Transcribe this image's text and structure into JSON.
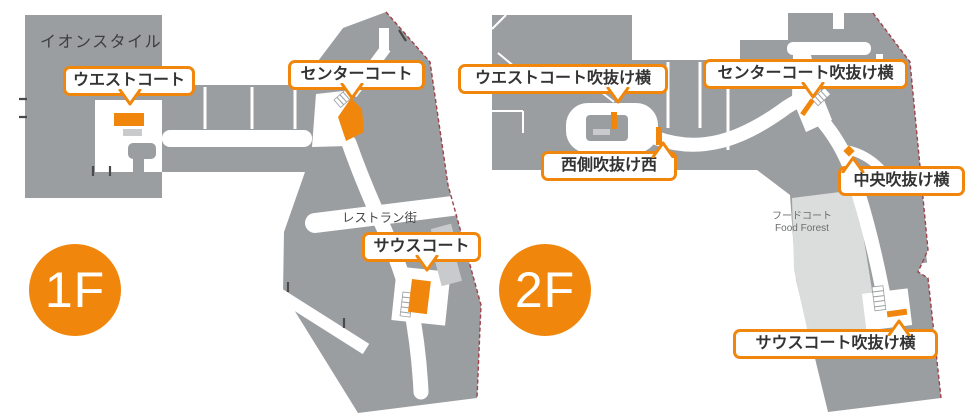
{
  "colors": {
    "orange": "#F0870C",
    "building_gray": "#9B9EA1",
    "light_gray": "#C9CACB",
    "foodcourt_gray": "#DBDCDC",
    "boundary_red": "#A04048",
    "text_dark": "#333333"
  },
  "floors": [
    {
      "badge": "1F",
      "area_labels": [
        {
          "text": "イオンスタイル"
        },
        {
          "text": "レストラン街"
        }
      ],
      "callouts": [
        {
          "label": "ウエストコート"
        },
        {
          "label": "センターコート"
        },
        {
          "label": "サウスコート"
        }
      ]
    },
    {
      "badge": "2F",
      "area_labels": [
        {
          "text": "フードコート"
        },
        {
          "text": "Food Forest"
        }
      ],
      "callouts": [
        {
          "label": "ウエストコート吹抜け横"
        },
        {
          "label": "センターコート吹抜け横"
        },
        {
          "label": "西側吹抜け西"
        },
        {
          "label": "中央吹抜け横"
        },
        {
          "label": "サウスコート吹抜け横"
        }
      ]
    }
  ]
}
